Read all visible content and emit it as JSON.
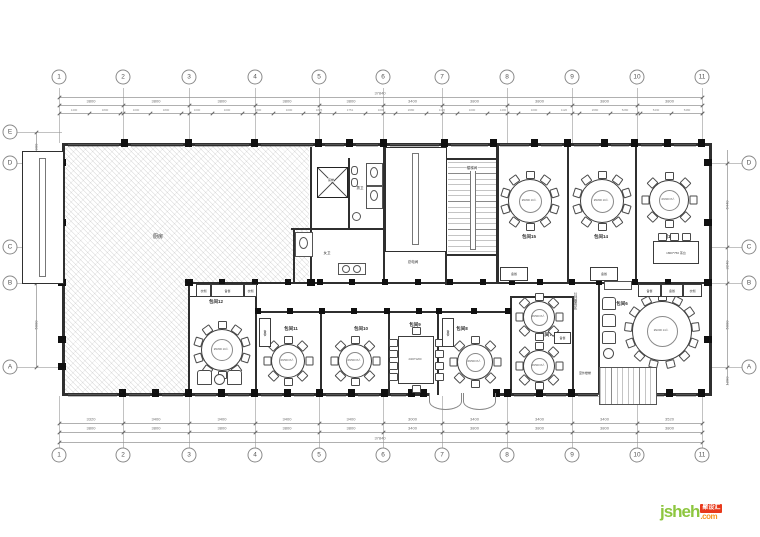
{
  "grid": {
    "top_numbers": [
      "1",
      "2",
      "3",
      "4",
      "5",
      "6",
      "7",
      "8",
      "9",
      "10",
      "11"
    ],
    "bottom_numbers": [
      "1",
      "2",
      "3",
      "4",
      "5",
      "6",
      "7",
      "8",
      "9",
      "10",
      "11"
    ],
    "left_letters": [
      "E",
      "D",
      "C",
      "B",
      "A"
    ],
    "right_letters": [
      "D",
      "C",
      "B",
      "A"
    ]
  },
  "dimensions": {
    "top_total": "37840",
    "bottom_total": "37840",
    "top_main": [
      "3800",
      "3800",
      "3800",
      "3800",
      "3800",
      "3400",
      "3800",
      "3800",
      "3800",
      "3800"
    ],
    "top_sub": [
      "1400",
      "1800",
      "1000",
      "1800",
      "1000",
      "1000",
      "1800",
      "1000",
      "1825",
      "1751",
      "1000",
      "2680",
      "1120",
      "1000",
      "1400",
      "1000",
      "1120",
      "2680",
      "5280",
      "5430",
      "5480"
    ],
    "bottom_inner": [
      "3320",
      "3400",
      "3400",
      "3400",
      "3400",
      "3000",
      "3400",
      "3400",
      "3400",
      "3520"
    ],
    "bottom_outer": [
      "3800",
      "3800",
      "3800",
      "3800",
      "3800",
      "3400",
      "3800",
      "3800",
      "3800",
      "3800"
    ],
    "left": [
      "900",
      "4600",
      "3000",
      "5000"
    ],
    "right": [
      "6440",
      "3240",
      "5000",
      "1290"
    ]
  },
  "labels": {
    "kitchen": "厨房",
    "food_lift": "菜梯",
    "mens_wc": "男卫",
    "womens_wc": "女卫",
    "stairwell": "楼梯间",
    "electrical": "总电间",
    "service_zone": "公共服务区",
    "outdoor_stair": "室外楼梯",
    "pantry": "备餐",
    "cloak": "衣帽",
    "tea_table": "1800*750 茶台"
  },
  "rooms": [
    {
      "id": "r15",
      "label": "包间15",
      "table": "Ø1800 10人"
    },
    {
      "id": "r14",
      "label": "包间14",
      "table": "Ø1800 10人"
    },
    {
      "id": "r13",
      "label": "包间13",
      "table": "Ø1600 8人"
    },
    {
      "id": "r12",
      "label": "包间12",
      "table": "Ø1800 10人"
    },
    {
      "id": "r11",
      "label": "包间11",
      "table": "Ø1500 8人"
    },
    {
      "id": "r10",
      "label": "包间10",
      "table": "Ø1500 8人"
    },
    {
      "id": "r9",
      "label": "包间9",
      "table": "2400*1200"
    },
    {
      "id": "r8",
      "label": "包间8",
      "table": "Ø1500 8人"
    },
    {
      "id": "r7",
      "label": "包间7",
      "table": "Ø1500 8人"
    },
    {
      "id": "r6",
      "label": "包间6",
      "table": "Ø2200 14人"
    }
  ],
  "watermark": {
    "brand": "jsheh",
    "tld": ".com",
    "badge": "聚设汇"
  }
}
